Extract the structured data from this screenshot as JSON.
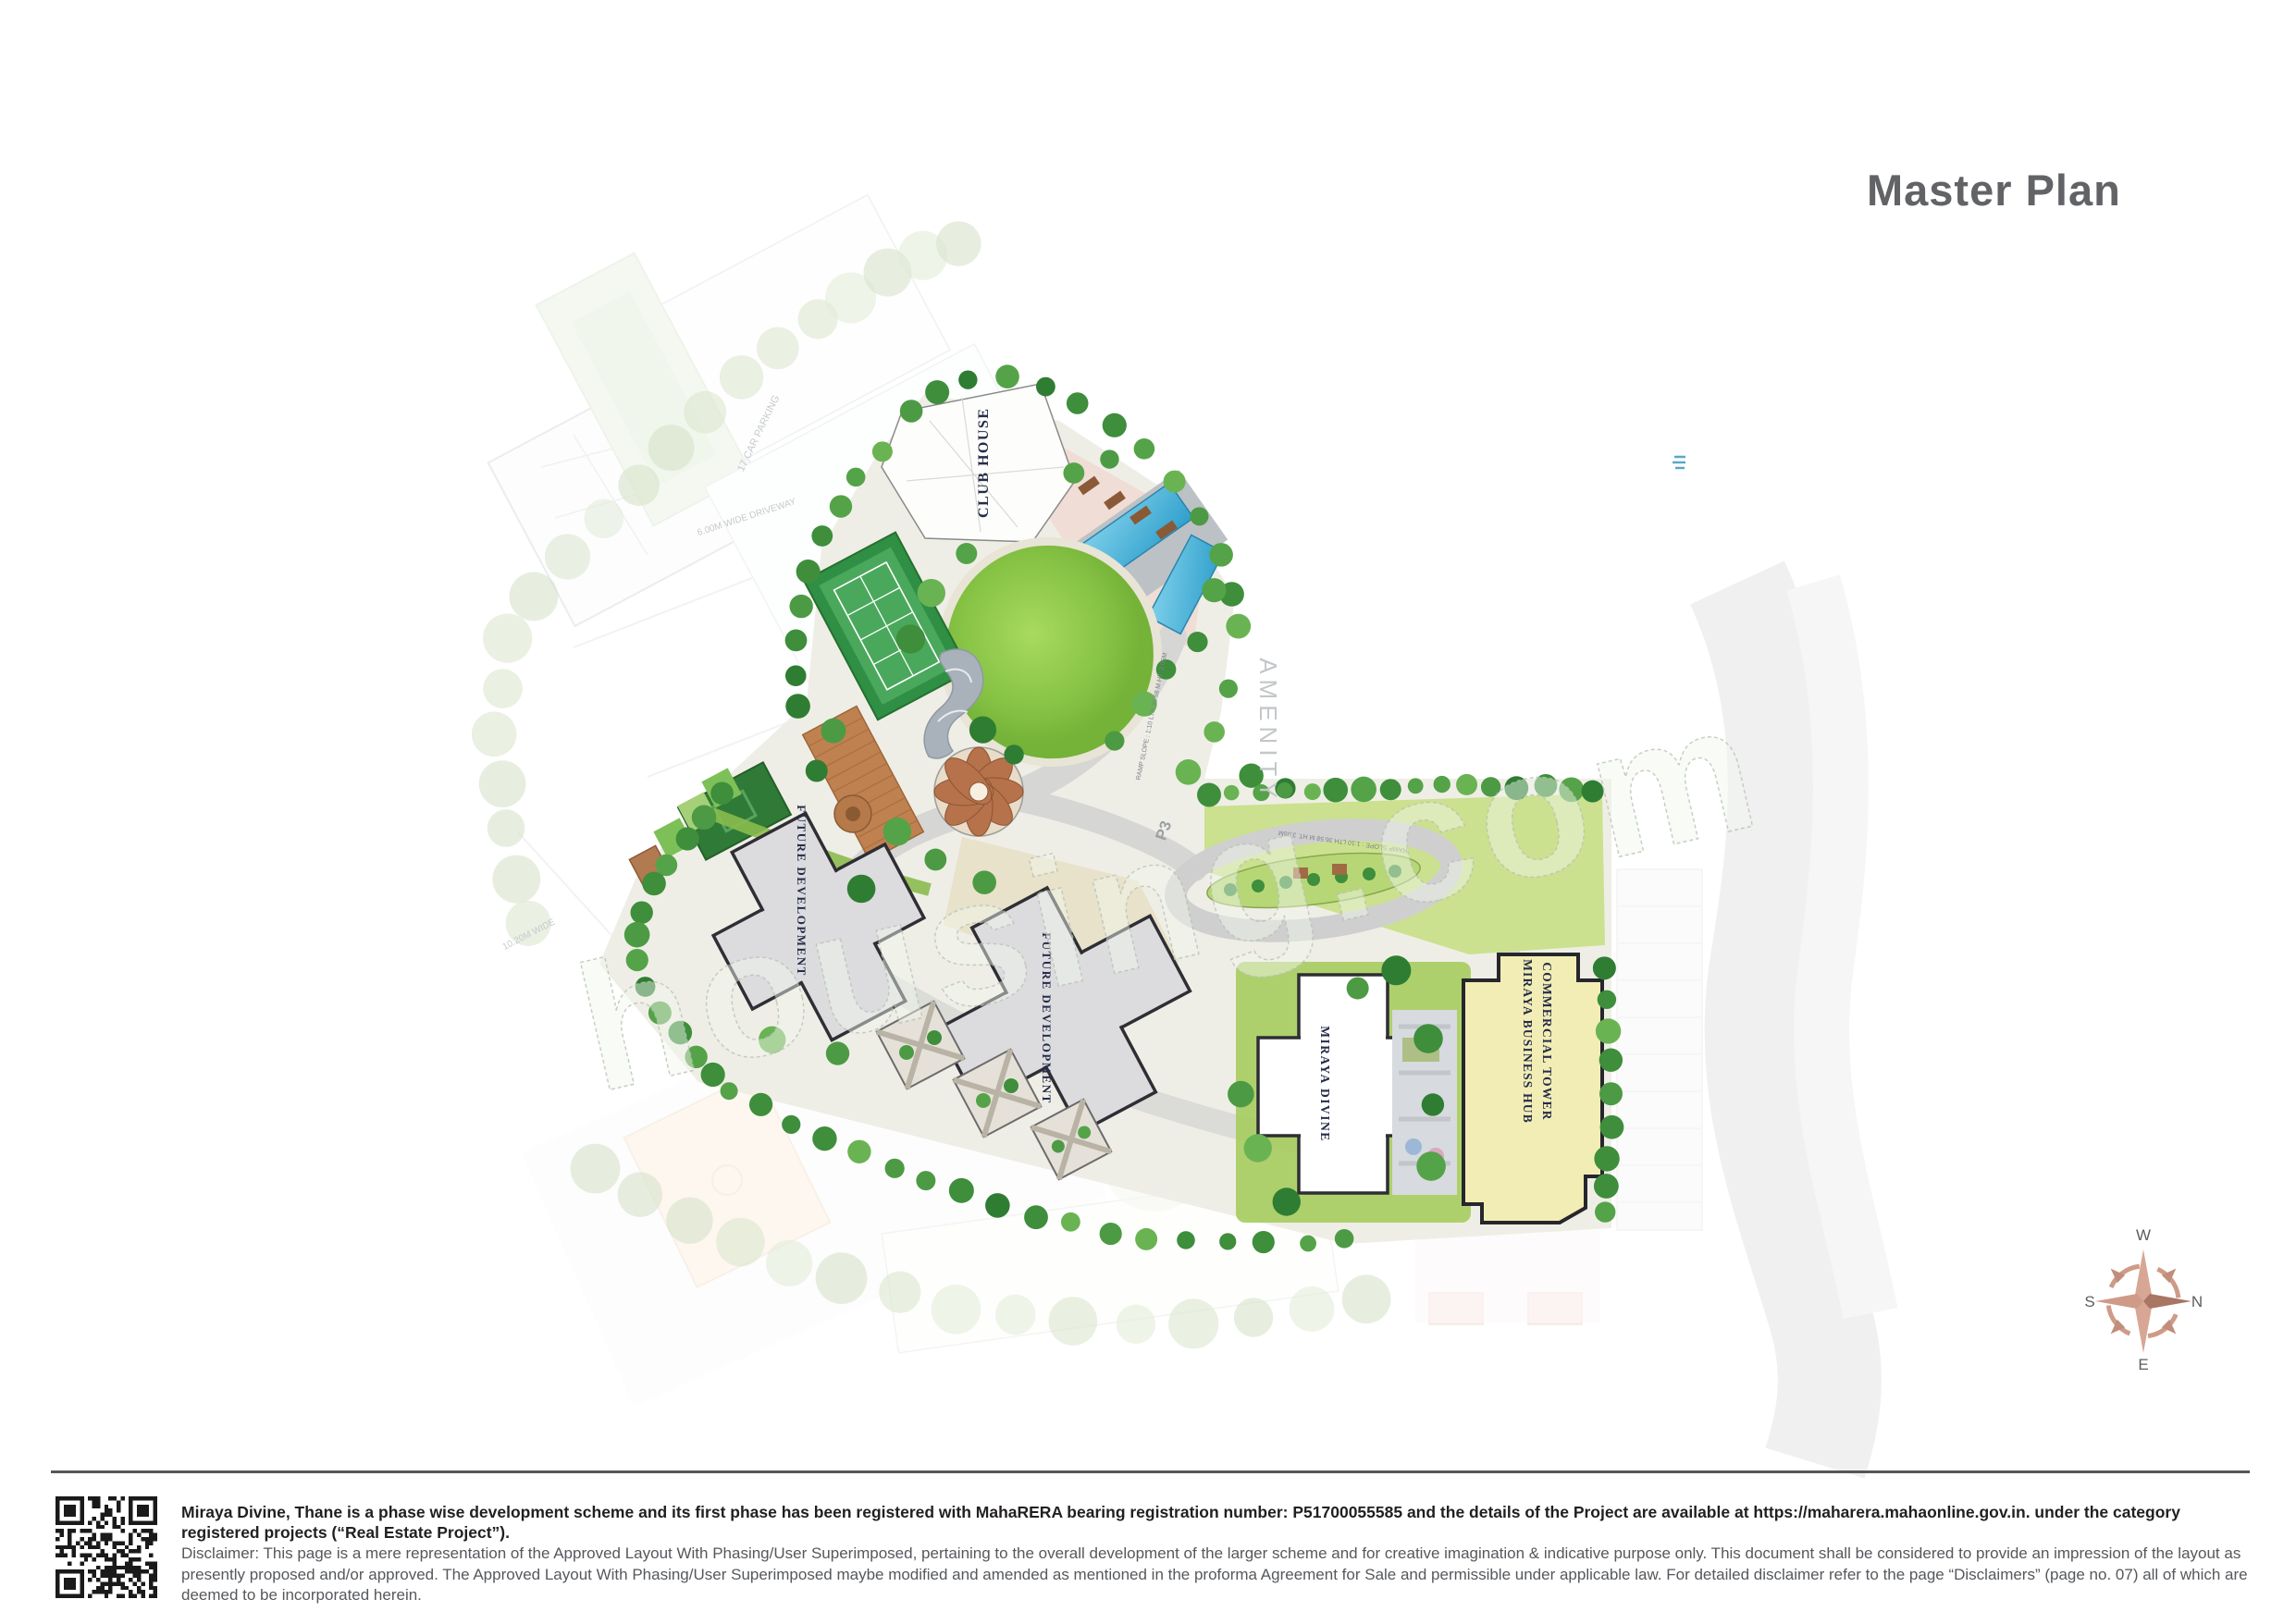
{
  "page": {
    "title": "Master Plan"
  },
  "map": {
    "labels": {
      "club_house": "CLUB HOUSE",
      "amenity": "AMENITY",
      "p3": "P3",
      "future_development": "FUTURE DEVELOPMENT",
      "miraya_divine": "MIRAYA DIVINE",
      "business_hub_line1": "MIRAYA BUSINESS HUB",
      "business_hub_line2": "COMMERCIAL TOWER",
      "car_parking": "17 CAR PARKING",
      "driveway": "6.00M WIDE DRIVEWAY",
      "road_width": "10.20M WIDE",
      "ramp_slope": "RAMP SLOPE : 1:10  LTH 36.58 M  HT. 3.05M"
    },
    "watermark": "housing.com"
  },
  "compass": {
    "north": "N",
    "south": "S",
    "east": "E",
    "west": "W"
  },
  "footer": {
    "registration_bold": "Miraya Divine, Thane is a phase wise development scheme and its first phase has been registered with MahaRERA bearing registration number: P51700055585 and the details of the Project are available at https://maharera.mahaonline.gov.in. under the category registered projects (“Real Estate Project”).",
    "disclaimer": "Disclaimer: This page is a mere representation of the Approved Layout With Phasing/User Superimposed, pertaining to the overall development of the larger scheme and for creative imagination & indicative purpose only. This document shall be considered to provide an impression of the layout as presently proposed and/or approved. The Approved Layout With Phasing/User Superimposed maybe modified and amended as mentioned in the proforma Agreement for Sale and permissible under applicable law. For detailed disclaimer refer to the page “Disclaimers” (page no. 07) all of which are deemed to be incorporated herein."
  },
  "colors": {
    "title_gray": "#626366",
    "lawn_green": "#7cb93e",
    "pool_blue": "#45b2dc",
    "commercial_yellow": "#f2edb5",
    "compass_rose": "#cf9b88",
    "compass_rose_dark": "#a97564",
    "qr_black": "#1a1a1a"
  }
}
